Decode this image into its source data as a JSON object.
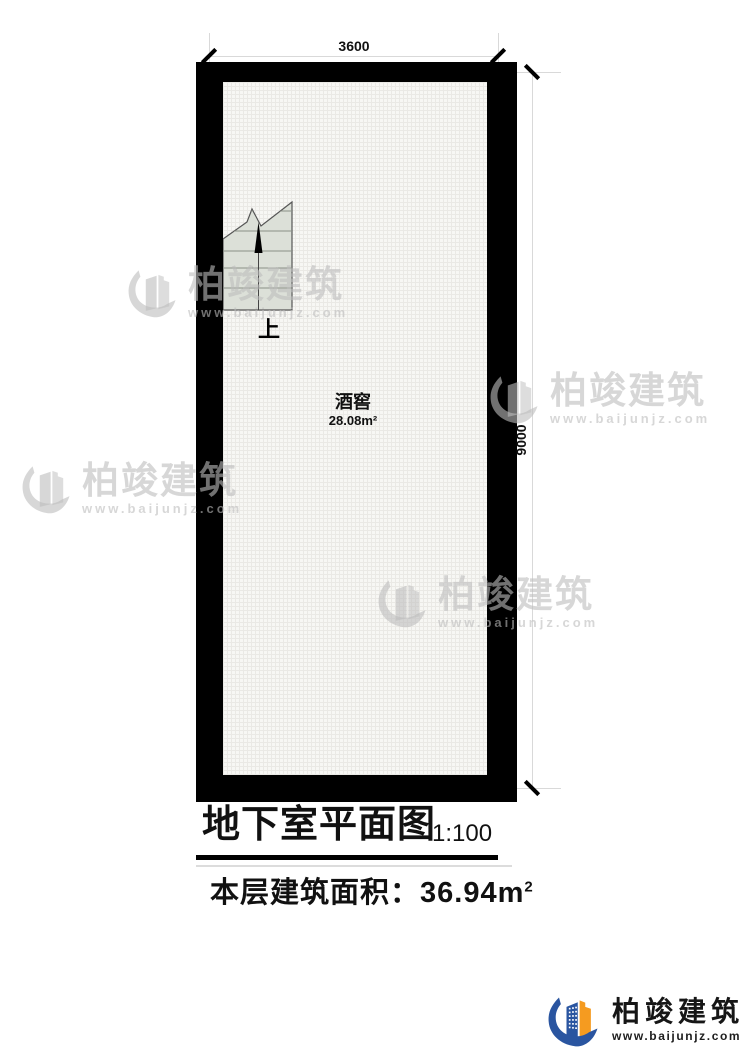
{
  "plan": {
    "dim_top": "3600",
    "dim_right": "9000",
    "room_name": "酒窖",
    "room_area": "28.08m²",
    "stair_direction_label": "上"
  },
  "title_block": {
    "title": "地下室平面图",
    "scale": "1:100",
    "area_text": "本层建筑面积：36.94m",
    "area_sup": "2"
  },
  "watermark": {
    "brand": "柏竣建筑",
    "url": "www.baijunjz.com",
    "icon": "building-logo-icon",
    "color": "#bcbcbc"
  },
  "footer": {
    "brand": "柏竣建筑",
    "url": "www.baijunjz.com",
    "icon": "building-logo-icon",
    "logo_blue": "#2a55a0",
    "logo_orange": "#f59b20"
  }
}
